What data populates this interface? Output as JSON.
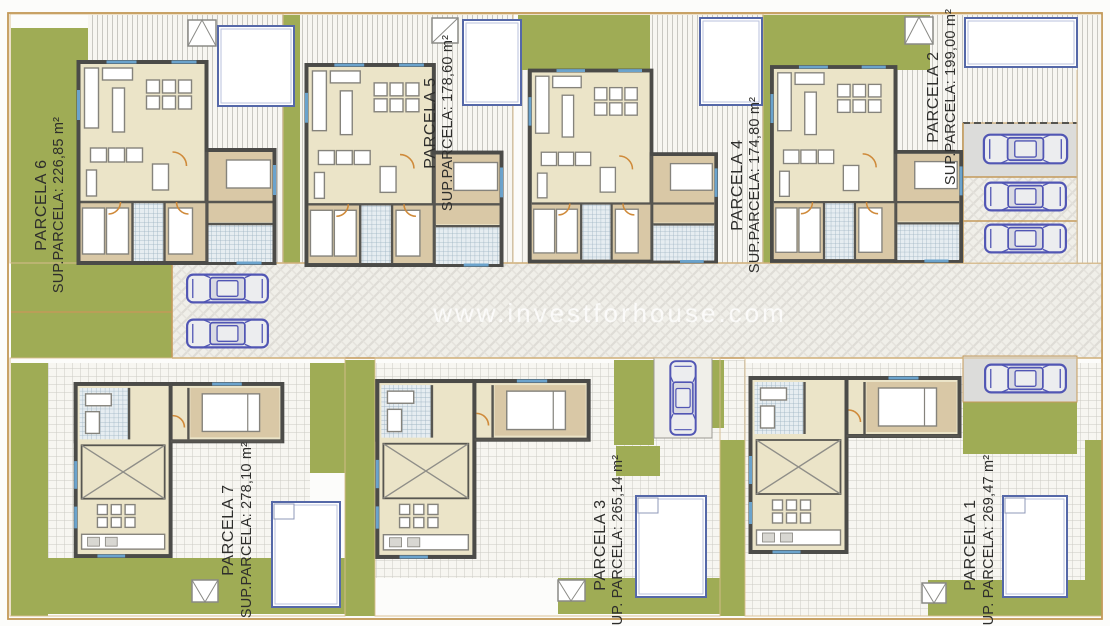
{
  "watermark": "www.investforhouse.com",
  "parcels": [
    {
      "name": "PARCELA 6",
      "area_label": "SUP.PARCELA: 226,85 m²"
    },
    {
      "name": "PARCELA 5",
      "area_label": "SUP.PARCELA: 178,60 m²"
    },
    {
      "name": "PARCELA 4",
      "area_label": "SUP.PARCELA: 174,80 m²"
    },
    {
      "name": "PARCELA 2",
      "area_label": "SUP.PARCELA: 199,00 m²"
    },
    {
      "name": "PARCELA 7",
      "area_label": "SUP.PARCELA: 278,10 m²"
    },
    {
      "name": "PARCELA 3",
      "area_label": "SUP. PARCELA: 265,14 m²"
    },
    {
      "name": "PARCELA 1",
      "area_label": "SUP. PARCELA: 269,47 m²"
    }
  ],
  "colors": {
    "grass": "#9fac55",
    "street": "#f0efe9",
    "wall": "#4b4b48",
    "room": "#ebe4c8",
    "bedroom": "#d9c8a6",
    "car_outline": "#5156b4",
    "pool_border": "#5568a8",
    "parcel_border": "#c49a5a",
    "label_text": "#2e2e2c",
    "watermark_color": "#ffffff"
  }
}
